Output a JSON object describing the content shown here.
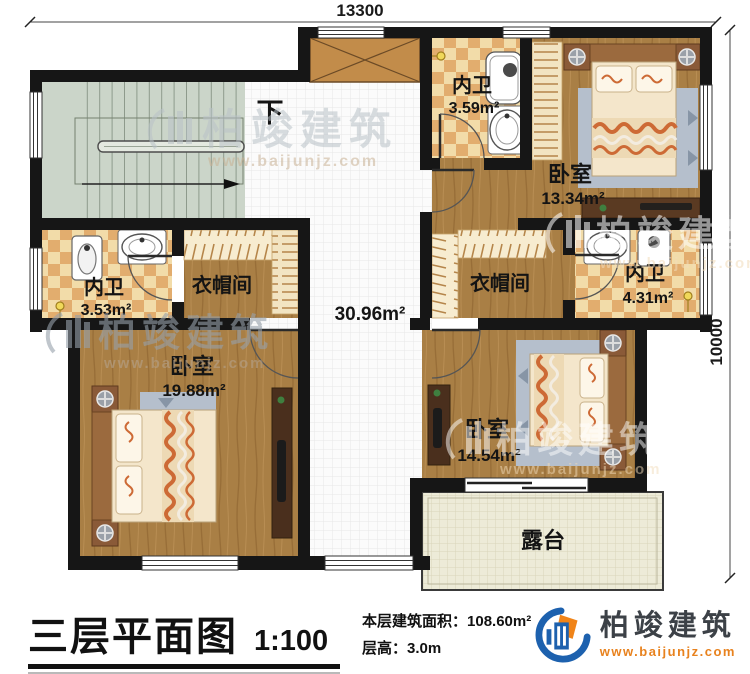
{
  "dimensions": {
    "width": "13300",
    "height": "10000"
  },
  "stairs": {
    "direction": "下"
  },
  "rooms": {
    "bath_upper": {
      "name": "内卫",
      "area": "3.59m²"
    },
    "bed_upper_right": {
      "name": "卧室",
      "area": "13.34m²"
    },
    "bath_left": {
      "name": "内卫",
      "area": "3.53m²"
    },
    "closet_left": {
      "name": "衣帽间"
    },
    "hall": {
      "area": "30.96m²"
    },
    "closet_right": {
      "name": "衣帽间"
    },
    "bath_right": {
      "name": "内卫",
      "area": "4.31m²"
    },
    "bed_lower_left": {
      "name": "卧室",
      "area": "19.88m²"
    },
    "bed_lower_right": {
      "name": "卧室",
      "area": "14.54m²"
    },
    "terrace": {
      "name": "露台"
    }
  },
  "footer": {
    "title": "三层平面图",
    "scale": "1:100",
    "area_label": "本层建筑面积：",
    "area_value": "108.60m²",
    "floor_height_label": "层高：",
    "floor_height_value": "3.0m"
  },
  "brand": {
    "name": "柏竣建筑",
    "url": "www.baijunjz.com"
  },
  "colors": {
    "wall": "#161616",
    "wood": "#a97f45",
    "checker_light": "#f2dca9",
    "checker_dark": "#e2ad6e",
    "stairs": "#cbd5c9",
    "hall_tile": "#fbfbfb",
    "terrace": "#edebd8",
    "rug": "#b5bfcc",
    "blanket_accent": "#cd6a35",
    "brand_blue": "#1d61ae",
    "brand_orange": "#f08418"
  }
}
